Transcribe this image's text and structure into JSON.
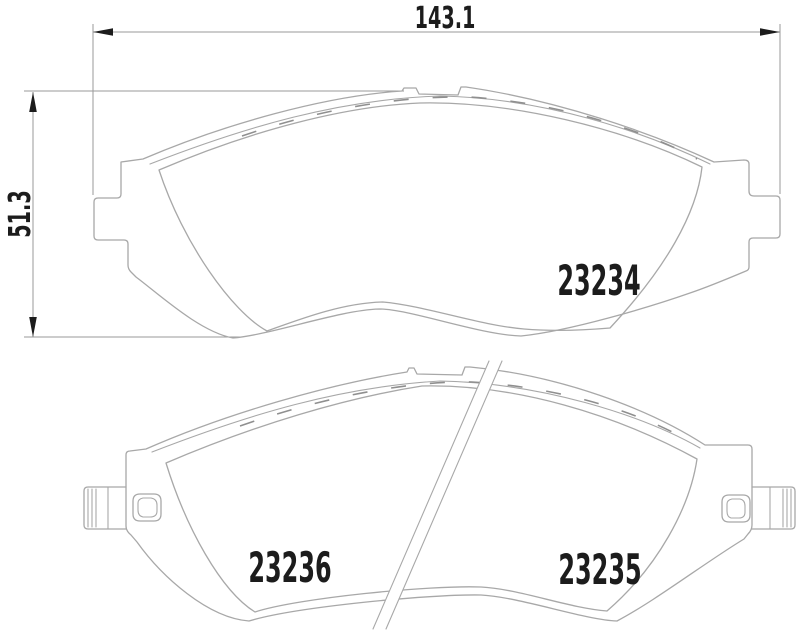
{
  "title": "Brake pad set technical drawing",
  "drawing": {
    "colors": {
      "background": "#ffffff",
      "line": "#a8a8a8",
      "dash": "#8f8f8f",
      "dim": "#9a9a9a",
      "text": "#1c1c1c"
    },
    "dimensions": {
      "width_label": "143.1",
      "height_label": "51.3"
    },
    "parts": [
      {
        "number": "23234",
        "location": "top-pad"
      },
      {
        "number": "23236",
        "location": "bottom-pad-left"
      },
      {
        "number": "23235",
        "location": "bottom-pad-right"
      }
    ]
  }
}
